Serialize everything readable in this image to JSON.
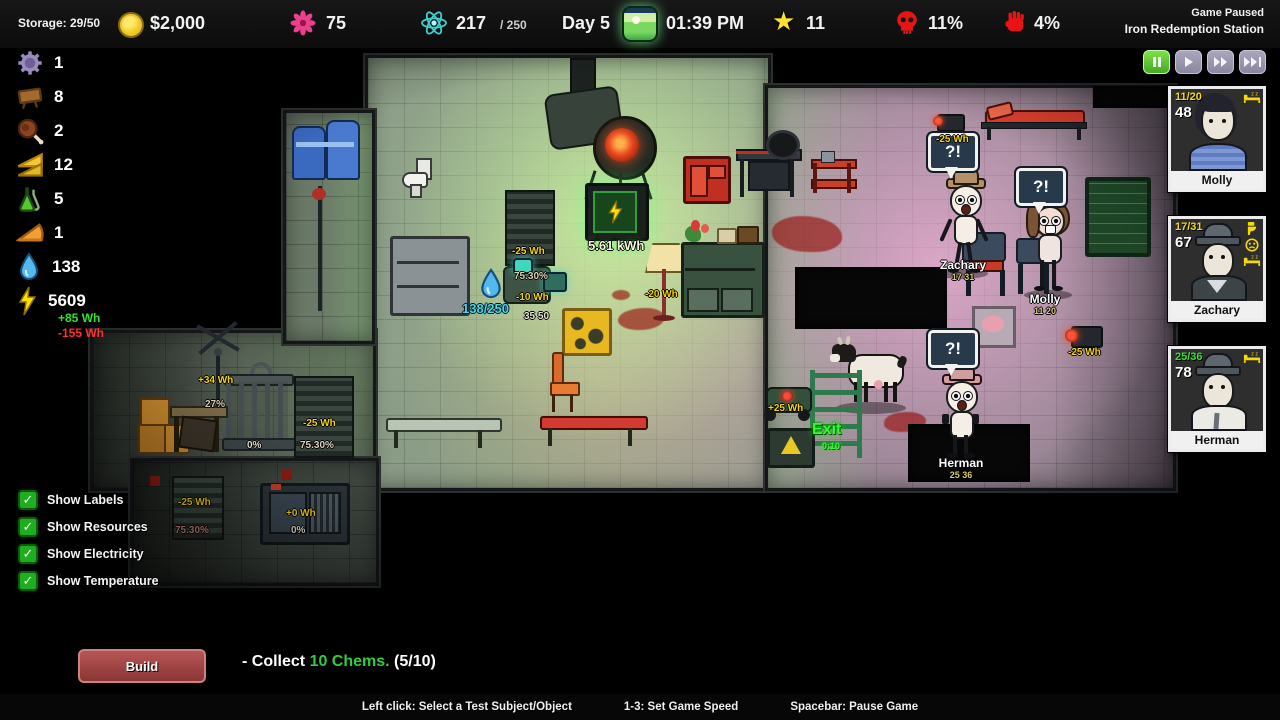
{
  "top_bar": {
    "storage": "Storage: 29/50",
    "money": "$2,000",
    "flowers": "75",
    "science_current": "217",
    "science_max": "/ 250",
    "day": "Day 5",
    "time": "01:39 PM",
    "stars": "11",
    "death_pct": "11%",
    "unrest_pct": "4%",
    "status_line1": "Game Paused",
    "status_line2": "Iron Redemption Station"
  },
  "resources": [
    {
      "name": "machine-parts",
      "value": "1"
    },
    {
      "name": "wood",
      "value": "8"
    },
    {
      "name": "meat",
      "value": "2"
    },
    {
      "name": "sandwich",
      "value": "12"
    },
    {
      "name": "chems",
      "value": "5"
    },
    {
      "name": "pie",
      "value": "1"
    },
    {
      "name": "water",
      "value": "138"
    },
    {
      "name": "power",
      "value": "5609",
      "gain": "+85 Wh",
      "drain": "-155 Wh"
    }
  ],
  "toggles": [
    {
      "label": "Show Labels",
      "checked": true
    },
    {
      "label": "Show Resources",
      "checked": true
    },
    {
      "label": "Show Electricity",
      "checked": true
    },
    {
      "label": "Show Temperature",
      "checked": true
    }
  ],
  "crew": [
    {
      "name": "Molly",
      "capacity": "11/20",
      "score": "48",
      "status_icons": [
        "sleep"
      ]
    },
    {
      "name": "Zachary",
      "capacity": "17/31",
      "score": "67",
      "status_icons": [
        "toilet",
        "unhappy",
        "sleep"
      ]
    },
    {
      "name": "Herman",
      "capacity": "25/36",
      "score": "78",
      "status_icons": [
        "sleep"
      ]
    }
  ],
  "map": {
    "labels": {
      "battery_charge": "5.61 kWh",
      "shelf_power": "-25 Wh",
      "purifier_pct": "75.30%",
      "purifier_power": "-10 Wh",
      "purifier_stats": "35 50",
      "water_level": "138/250",
      "lamp_power": "-20 Wh",
      "turbine_power": "+34 Wh",
      "turbine_pct": "27%",
      "cage_pct": "0%",
      "locker_power": "-25 Wh",
      "locker_pct": "75.30%",
      "basement_power": "-25 Wh",
      "basement_pct": "75.30%",
      "console_power": "+0 Wh",
      "console_pct": "0%",
      "rover_power": "+25 Wh",
      "exit_label": "Exit",
      "exit_timer": "0:10",
      "camera_a_power": "-25 Wh",
      "camera_b_power": "-25 Wh",
      "speech": "?!"
    },
    "characters": [
      {
        "name": "Zachary",
        "stats": "17 31"
      },
      {
        "name": "Molly",
        "stats": "11 20"
      },
      {
        "name": "Herman",
        "stats": "25 36"
      }
    ]
  },
  "objective": {
    "build_label": "Build",
    "prefix": "- Collect ",
    "target": "10 Chems.",
    "progress": " (5/10)"
  },
  "help_bar": {
    "select": "Left click: Select a Test Subject/Object",
    "speed": "1-3: Set Game Speed",
    "pause": "Spacebar: Pause Game"
  },
  "colors": {
    "label_yellow": "#f5d400",
    "gain_green": "#35e02f",
    "drain_red": "#ff3030",
    "water_cyan": "#45d8dc",
    "exit_green": "#2eff2e",
    "capacity_green": "#35e02f",
    "capacity_yellow": "#f5d90a"
  }
}
